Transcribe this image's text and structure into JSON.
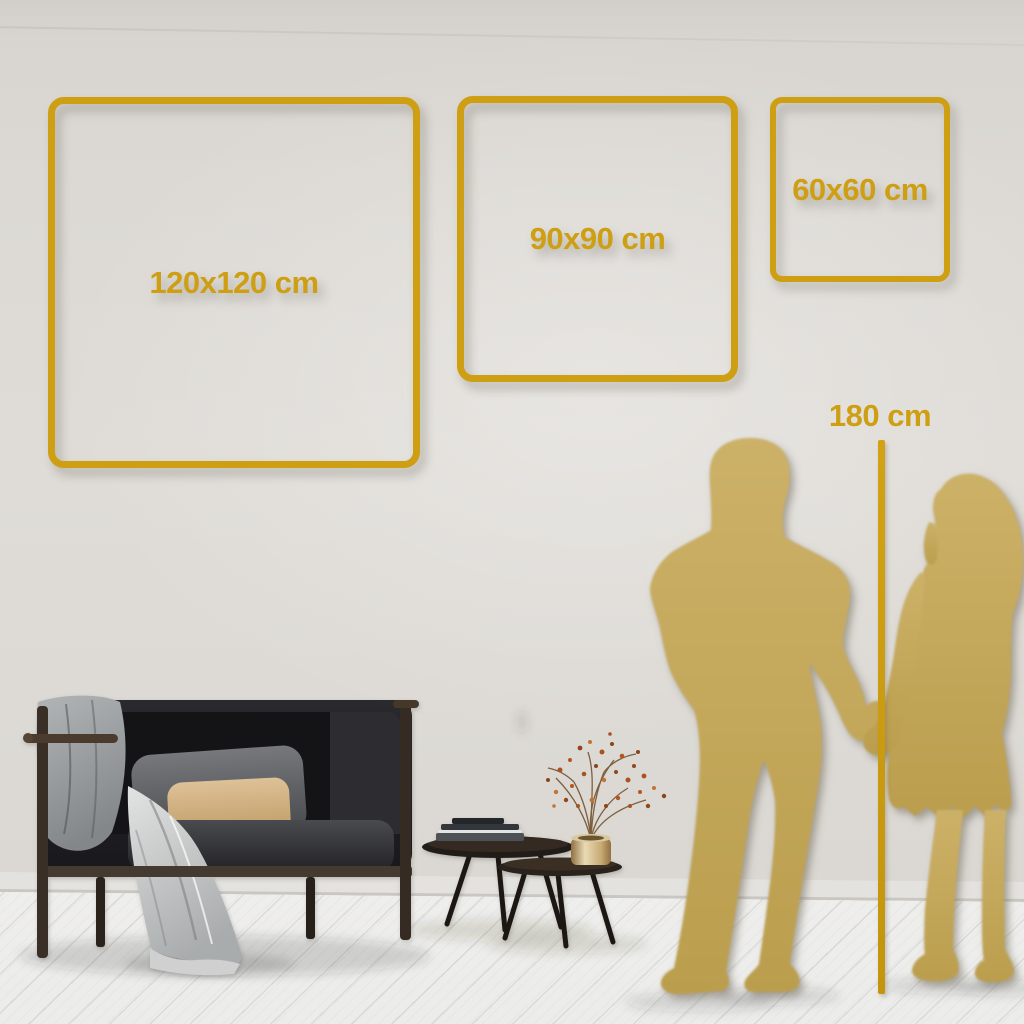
{
  "guide": {
    "type": "wall-art-size-comparison",
    "frames": [
      {
        "id": "size-120",
        "label": "120x120 cm"
      },
      {
        "id": "size-90",
        "label": "90x90 cm"
      },
      {
        "id": "size-60",
        "label": "60x60 cm"
      }
    ],
    "height_reference": {
      "label": "180 cm"
    },
    "colors": {
      "accent_gold": "#CE9E13",
      "silhouette_gold": "#C5A95B",
      "wall": "#DCD9D4",
      "floor": "#F5F4F2",
      "sofa_dark": "#1E1E21",
      "pillow_tan": "#D7B88B",
      "blanket_gray": "#9FA2A4"
    },
    "illustrations": [
      "couple-silhouette",
      "sofa-illustration",
      "coffee-tables-illustration",
      "vase-branch-illustration",
      "draped-blanket-illustration"
    ]
  }
}
